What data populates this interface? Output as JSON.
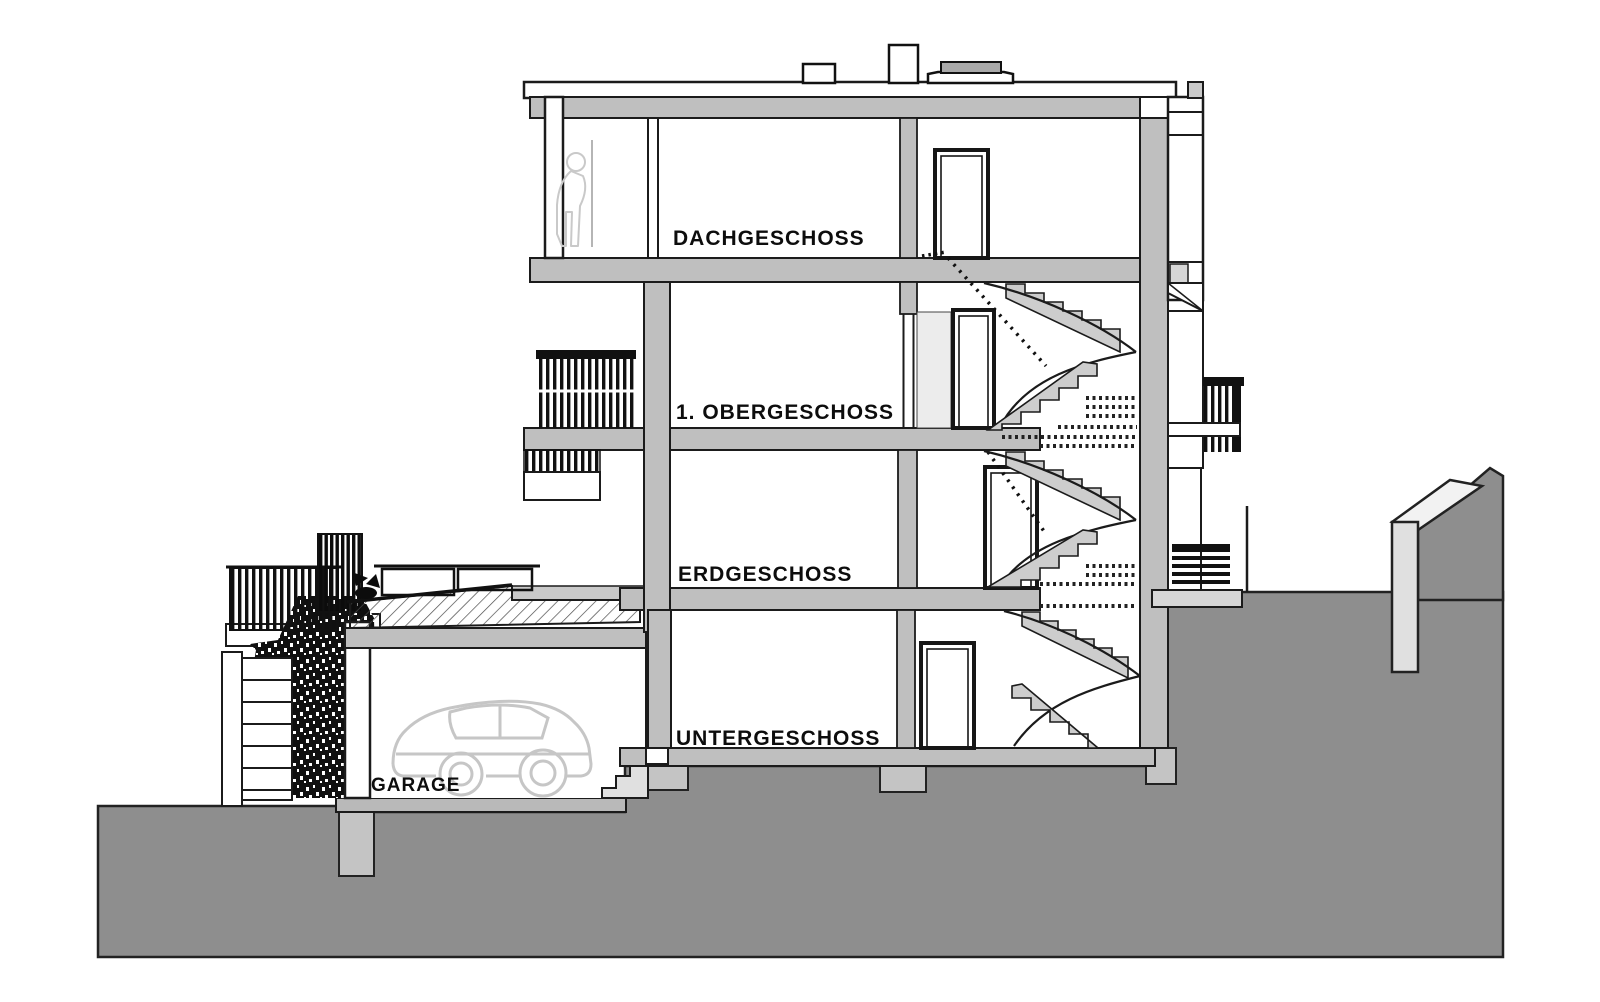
{
  "drawing": {
    "type": "architectural-section",
    "floor_labels": {
      "dachgeschoss": "DACHGESCHOSS",
      "obergeschoss": "1. OBERGESCHOSS",
      "erdgeschoss": "ERDGESCHOSS",
      "untergeschoss": "UNTERGESCHOSS",
      "garage": "GARAGE"
    },
    "colors": {
      "line": "#1b1b1b",
      "cut_wall": "#bfbfbf",
      "stair_fill": "#cdcdcd",
      "terrain": "#8e8e8e",
      "light_slab": "#d9d9d9",
      "car_outline": "#c6c6c6",
      "background": "#ffffff"
    }
  }
}
